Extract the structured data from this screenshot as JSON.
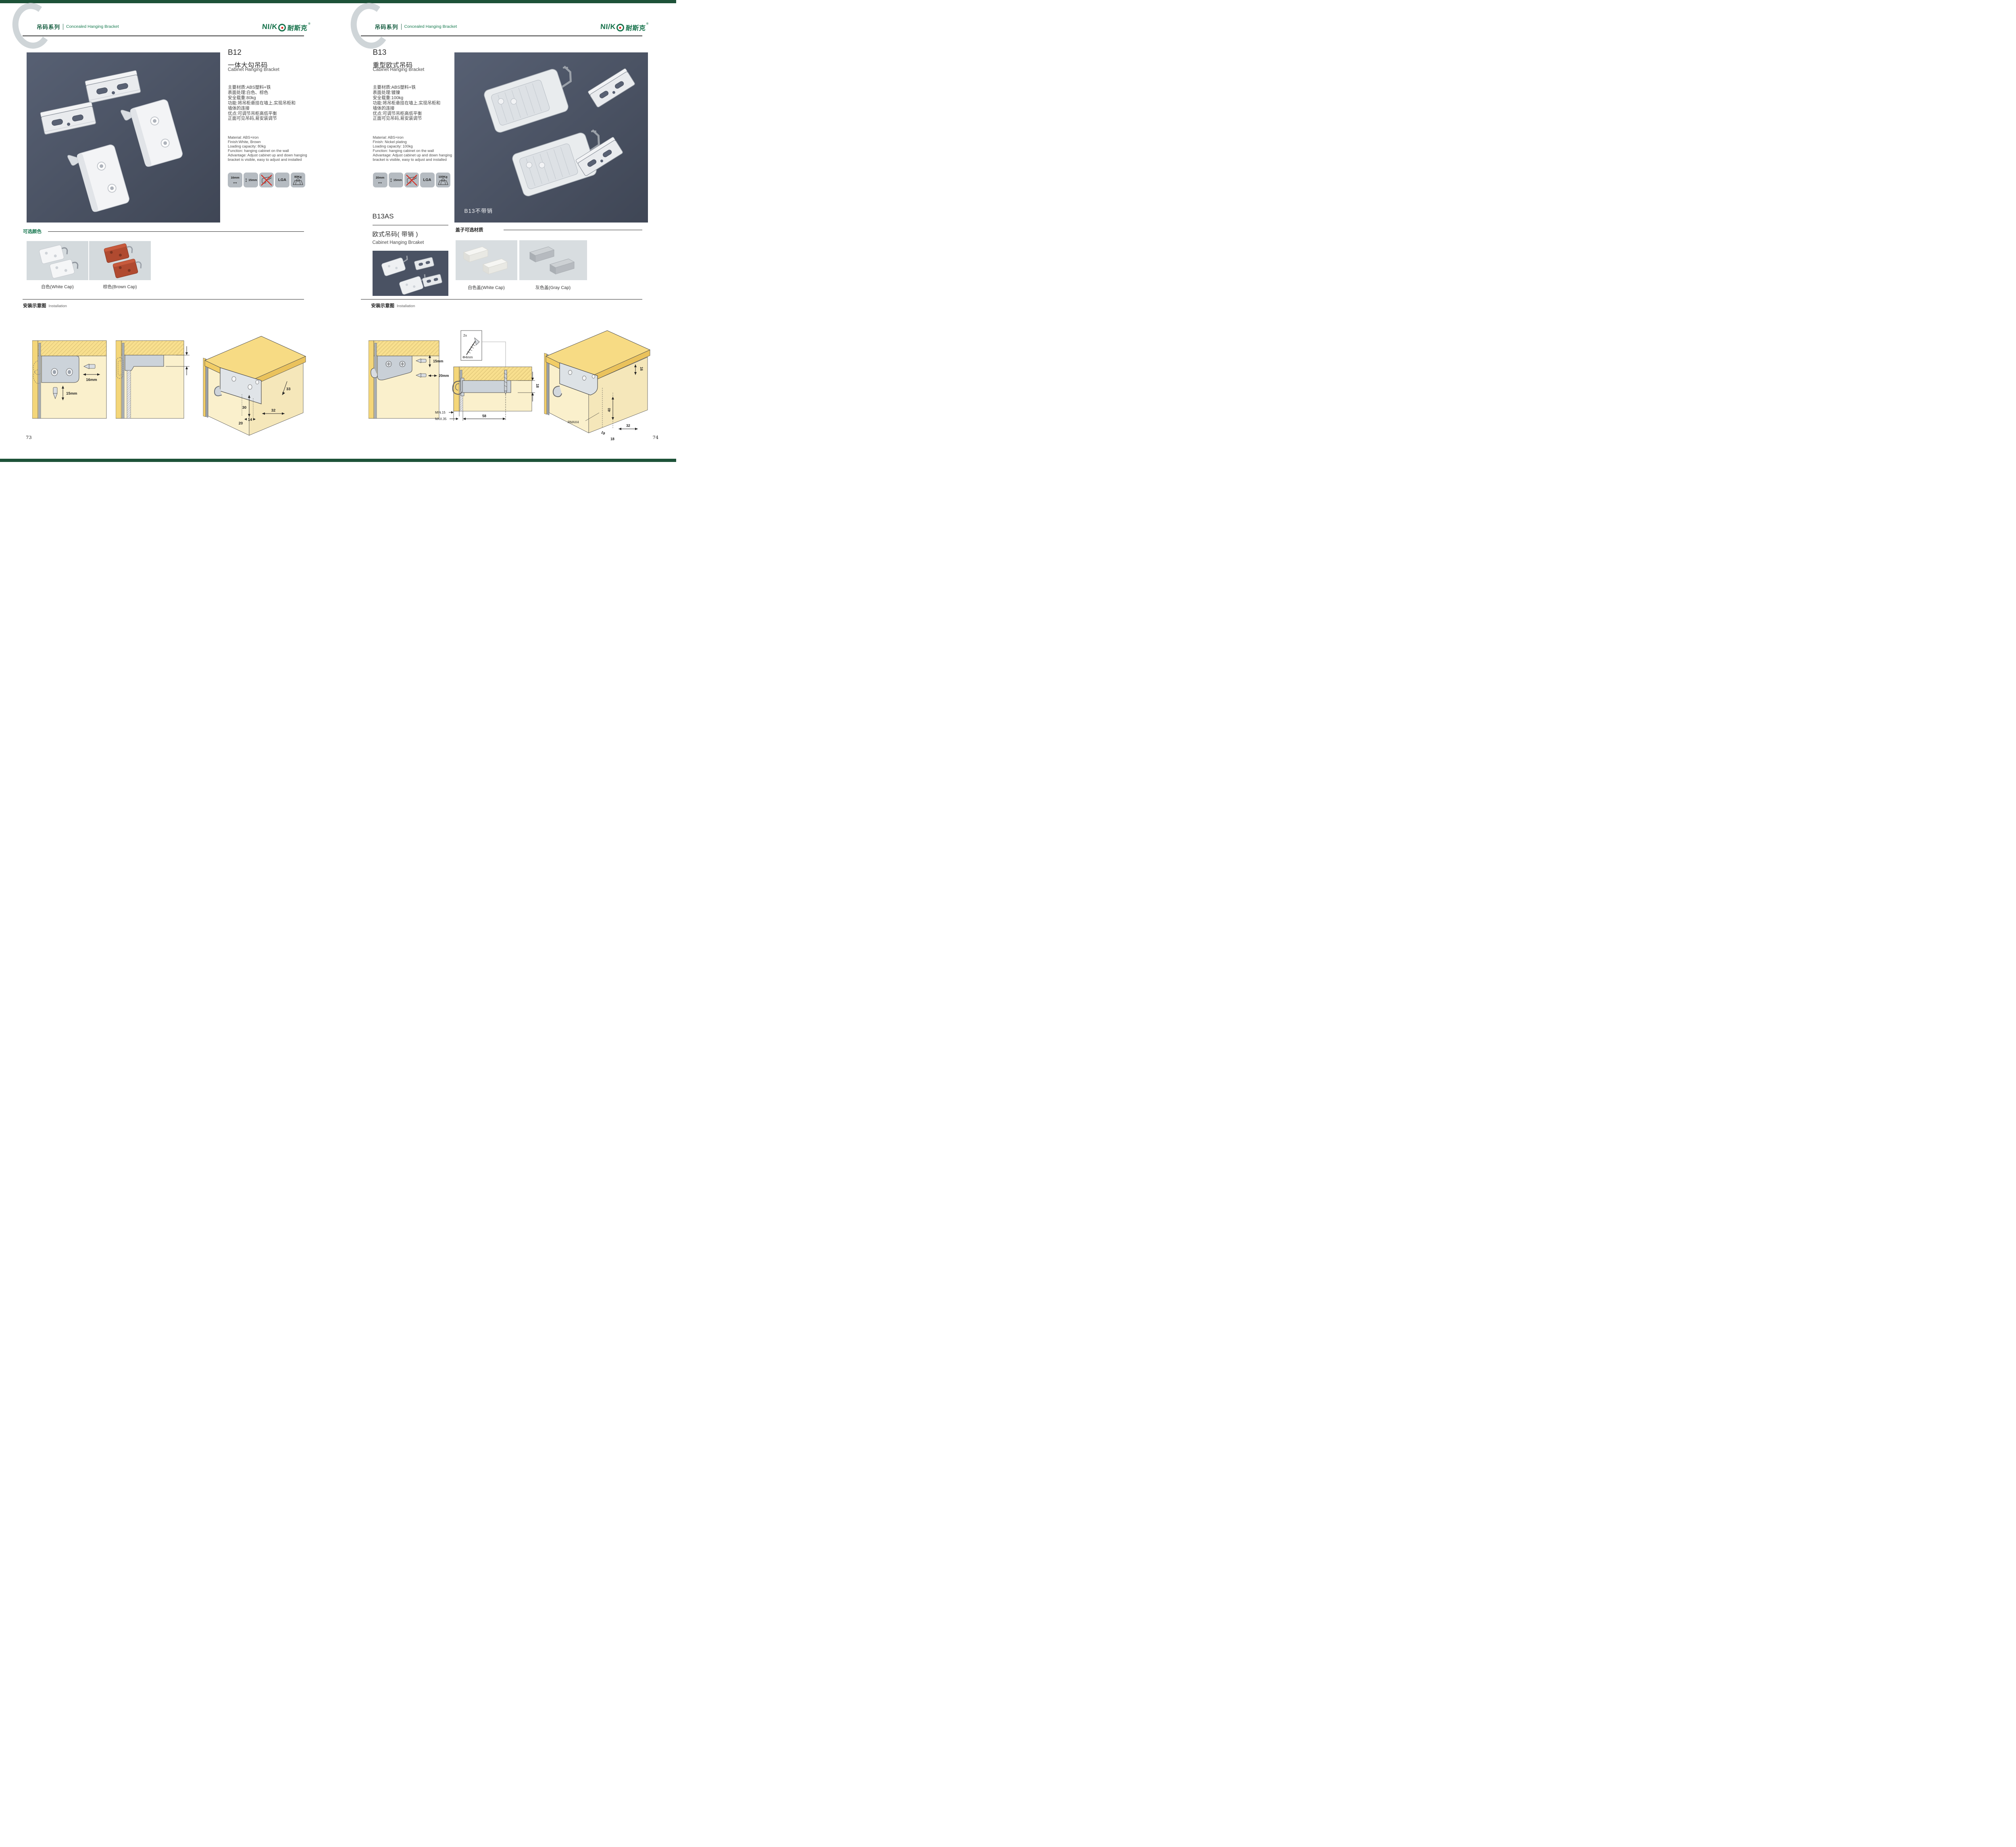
{
  "colors": {
    "brand_green": "#15714a",
    "edge_bar_green": "#1d5238",
    "photo_background": "#4c5466",
    "light_tile": "#d4dadd",
    "icon_tile_gray": "#b5bbc1",
    "diagram_cream": "#faf0cc",
    "diagram_wood_yellow": "#f4d679",
    "accent_red": "#dd2018",
    "brown_cap": "#b04a30"
  },
  "header": {
    "series_cn": "吊码系列",
    "series_en": "Concealed Hanging Bracket",
    "logo_latin": "NI/K",
    "logo_cn": "耐斯克",
    "logo_reg": "®"
  },
  "left_page": {
    "page_number": "73",
    "product": {
      "code": "B12",
      "name_cn": "一体大勾吊码",
      "name_en": "Cabinet Hanging Bracket",
      "specs_cn": [
        "主要材质:ABS塑料+铁",
        "表面处理:白色、棕色",
        "安全载重:80kg",
        "功能:将吊柜悬挂在墙上,实现吊柜和",
        "墙体的连接",
        "优点:可调节吊柜高低平衡",
        "正面可见吊码,易安装调节"
      ],
      "specs_en": [
        "Material: ABS+iron",
        "Finish:White, Brown",
        "Loading capacity: 80kg",
        "Function: hanging cabinet on the wall",
        "Advantage: Adjust cabinet up and down hanging",
        "bracket is visible, easy to adjust and installed"
      ],
      "icon_width": "16mm",
      "icon_height": "15mm",
      "icon_cert": "LGA",
      "icon_load": "80Kg"
    },
    "color_section": {
      "title": "可选颜色",
      "option1": "白色(White Cap)",
      "option2": "棕色(Brown Cap)"
    },
    "installation": {
      "title_cn": "安装示意图",
      "title_en": "Installation",
      "d1_width": "16mm",
      "d1_height": "15mm",
      "d2_dim": "18",
      "d3_dims": [
        "33",
        "30",
        "32",
        "20",
        "14"
      ]
    }
  },
  "right_page": {
    "page_number": "74",
    "product": {
      "code": "B13",
      "name_cn": "重型欧式吊码",
      "name_en": "Cabinet Hanging Bracket",
      "specs_cn": [
        "主要材质:ABS塑料+铁",
        "表面处理:镀镍",
        "安全载重:100kg",
        "功能:将吊柜悬挂在墙上,实现吊柜和",
        "墙体的连接",
        "优点:可调节吊柜高低平衡",
        "正面可见吊码,易安装调节"
      ],
      "specs_en": [
        "Material: ABS+iron",
        "Finish: Nickel plating",
        "Loading capacity: 100kg",
        "Function: hanging cabinet on the wall",
        "Advantage: Adjust cabinet up and down hanging",
        "bracket is visible, easy to adjust and installed"
      ],
      "icon_width": "20mm",
      "icon_height": "15mm",
      "icon_cert": "LGA",
      "icon_load": "100Kg"
    },
    "image_label": "B13不带销",
    "subproduct": {
      "code": "B13AS",
      "name_cn": "欧式吊码( 带销 )",
      "name_en": "Cabinet Hanging Brcaket"
    },
    "caps_section": {
      "title": "盖子可选材质",
      "option1": "白色盖(White Cap)",
      "option2": "灰色盖(Gray Cap)"
    },
    "installation": {
      "title_cn": "安装示意图",
      "title_en": "Installation",
      "d1_height": "15mm",
      "d1_width": "20mm",
      "d2_screw_count": "2x",
      "d2_screw_dia": "Φ4mm",
      "d2_dim18": "18",
      "d2_min": "MIN.15",
      "d2_max": "MAX.35",
      "d2_len": "58",
      "d3_dims": [
        "16",
        "40",
        "RMAX4",
        "19",
        "18",
        "32"
      ]
    }
  }
}
